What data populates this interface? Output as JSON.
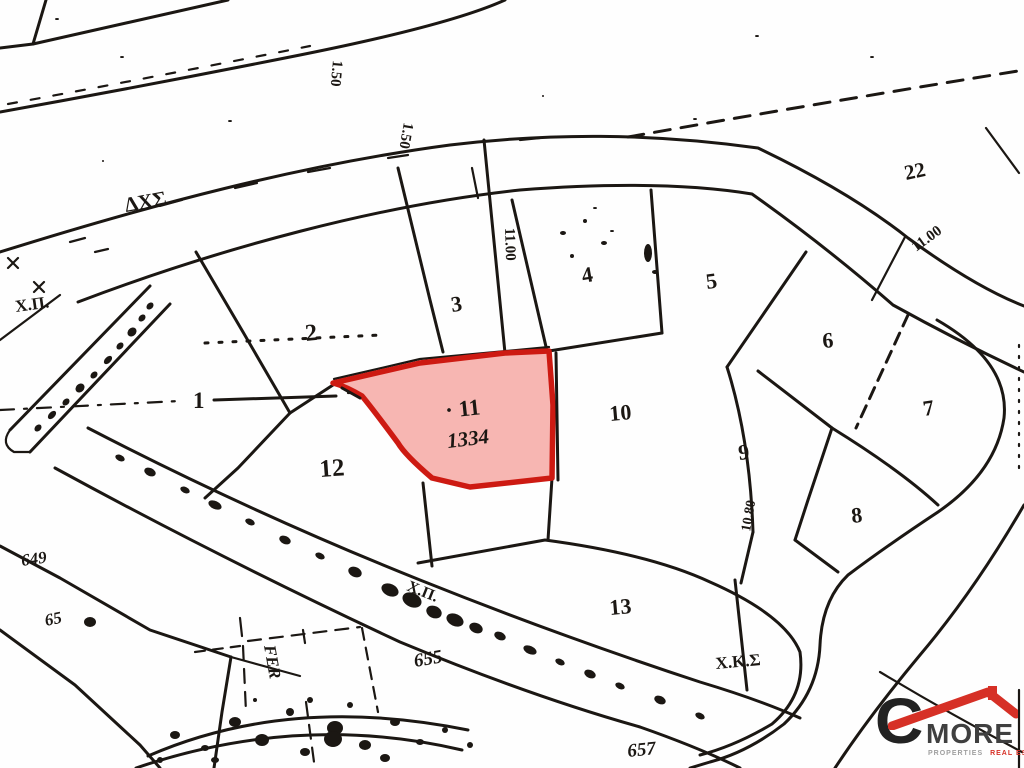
{
  "map": {
    "title": "cadastral-plan",
    "highlighted_parcel": {
      "number": "11",
      "area_value": "1334"
    },
    "colors": {
      "ink": "#1b1713",
      "parcel_fill": "#f7b6b2",
      "parcel_stroke": "#cd1a12",
      "red_ink": "#451a14",
      "paper": "#fefefe"
    },
    "labels": [
      {
        "name": "boundary-abbrev-dxs",
        "text": "ΔΧΣ",
        "x": 126,
        "y": 212,
        "size": 21,
        "rot": -10
      },
      {
        "name": "annotation-xp-upper",
        "text": "Χ.Π.",
        "x": 16,
        "y": 312,
        "size": 17,
        "rot": -8
      },
      {
        "name": "dim-150-track",
        "text": "1.50",
        "x": 333,
        "y": 60,
        "size": 15,
        "rot": 95
      },
      {
        "name": "dim-150-road",
        "text": "1.50",
        "x": 404,
        "y": 122,
        "size": 15,
        "rot": 100
      },
      {
        "name": "dim-1100-mid",
        "text": "11.00",
        "x": 505,
        "y": 228,
        "size": 15,
        "rot": 88
      },
      {
        "name": "plot-1",
        "text": "1",
        "x": 193,
        "y": 408,
        "size": 23,
        "rot": 0
      },
      {
        "name": "plot-2",
        "text": "2",
        "x": 306,
        "y": 341,
        "size": 24,
        "rot": -6
      },
      {
        "name": "plot-3",
        "text": "3",
        "x": 452,
        "y": 312,
        "size": 22,
        "rot": -8
      },
      {
        "name": "plot-4",
        "text": "4",
        "x": 583,
        "y": 283,
        "size": 22,
        "rot": -10
      },
      {
        "name": "plot-5",
        "text": "5",
        "x": 707,
        "y": 289,
        "size": 22,
        "rot": -8
      },
      {
        "name": "plot-22",
        "text": "22",
        "x": 906,
        "y": 180,
        "size": 21,
        "rot": -12
      },
      {
        "name": "dim-1100-right",
        "text": "11.00",
        "x": 916,
        "y": 252,
        "size": 15,
        "rot": -36
      },
      {
        "name": "plot-6",
        "text": "6",
        "x": 823,
        "y": 348,
        "size": 22,
        "rot": -5
      },
      {
        "name": "plot-7",
        "text": "7",
        "x": 924,
        "y": 416,
        "size": 22,
        "rot": -8
      },
      {
        "name": "plot-10",
        "text": "10",
        "x": 610,
        "y": 421,
        "size": 22,
        "rot": -5
      },
      {
        "name": "plot-9",
        "text": "9",
        "x": 739,
        "y": 460,
        "size": 22,
        "rot": -6
      },
      {
        "name": "dim-1080",
        "text": "10.80",
        "x": 750,
        "y": 532,
        "size": 14,
        "rot": -80
      },
      {
        "name": "plot-8",
        "text": "8",
        "x": 852,
        "y": 523,
        "size": 22,
        "rot": -6
      },
      {
        "name": "plot-12",
        "text": "12",
        "x": 320,
        "y": 477,
        "size": 25,
        "rot": -4
      },
      {
        "name": "plot-11",
        "text": "· 11",
        "x": 446,
        "y": 418,
        "size": 23,
        "rot": -6,
        "color": "red_ink"
      },
      {
        "name": "plot-11-area",
        "text": "1334",
        "x": 448,
        "y": 448,
        "size": 21,
        "rot": -7,
        "color": "red_ink",
        "style": "italic"
      },
      {
        "name": "plot-13",
        "text": "13",
        "x": 610,
        "y": 615,
        "size": 22,
        "rot": -5
      },
      {
        "name": "annotation-xks",
        "text": "Χ.Κ.Σ",
        "x": 716,
        "y": 669,
        "size": 17,
        "rot": -5
      },
      {
        "name": "ref-655",
        "text": "655",
        "x": 415,
        "y": 667,
        "size": 19,
        "rot": -10,
        "style": "italic"
      },
      {
        "name": "ref-657",
        "text": "657",
        "x": 628,
        "y": 757,
        "size": 19,
        "rot": -6,
        "style": "italic"
      },
      {
        "name": "ref-649",
        "text": "649",
        "x": 22,
        "y": 566,
        "size": 17,
        "rot": -8,
        "style": "italic"
      },
      {
        "name": "ref-65",
        "text": "65",
        "x": 46,
        "y": 626,
        "size": 17,
        "rot": -12,
        "style": "italic"
      },
      {
        "name": "annotation-xp-road",
        "text": "Χ.Π.",
        "x": 406,
        "y": 590,
        "size": 16,
        "rot": 22
      },
      {
        "name": "annotation-fer",
        "text": "FER",
        "x": 264,
        "y": 646,
        "size": 17,
        "rot": 80,
        "style": "italic"
      }
    ]
  },
  "logo": {
    "letter": "C",
    "word": "MORE",
    "tagline_gray": "PROPERTIES",
    "tagline_red": "REAL ESTATES",
    "red": "#d63026",
    "dark": "#222222"
  }
}
